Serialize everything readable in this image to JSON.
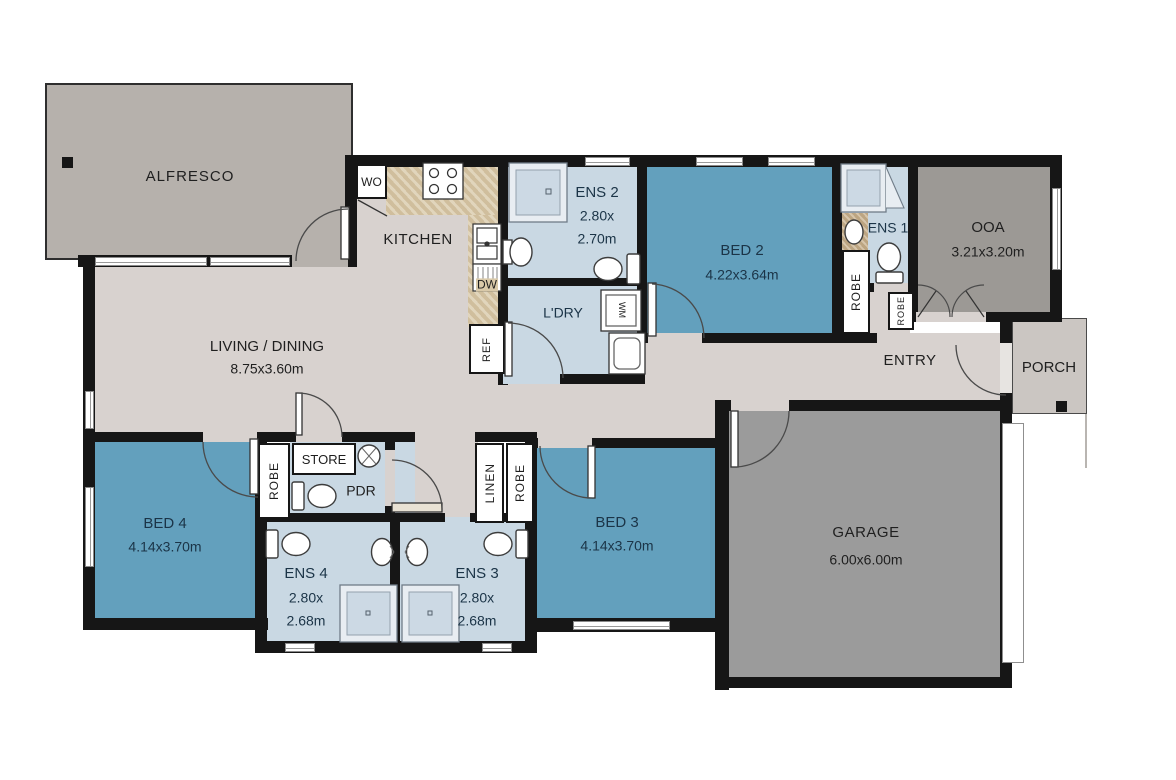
{
  "colors": {
    "wall": "#161616",
    "floor_main": "#d8d2cf",
    "floor_bedroom": "#63a0bd",
    "floor_wet_area": "#c9d8e3",
    "floor_alfresco": "#b6b1ac",
    "floor_garage": "#9b9b9b",
    "floor_ooa": "#9c9995",
    "floor_porch": "#cbc6c2",
    "benchtop": "#d9c9a9",
    "vanity": "#c8b18e",
    "label_text": "#1f1f1f",
    "label_text_blue_rooms": "#1b3447"
  },
  "rooms": {
    "alfresco": {
      "name": "ALFRESCO"
    },
    "kitchen": {
      "name": "KITCHEN"
    },
    "living": {
      "name": "LIVING / DINING",
      "dims": "8.75x3.60m"
    },
    "ens2": {
      "name": "ENS 2",
      "dims_a": "2.80x",
      "dims_b": "2.70m"
    },
    "laundry": {
      "name": "L'DRY"
    },
    "bed2": {
      "name": "BED 2",
      "dims": "4.22x3.64m"
    },
    "ens1": {
      "name": "ENS 1"
    },
    "ooa": {
      "name": "OOA",
      "dims": "3.21x3.20m"
    },
    "entry": {
      "name": "ENTRY"
    },
    "porch": {
      "name": "PORCH"
    },
    "garage": {
      "name": "GARAGE",
      "dims": "6.00x6.00m"
    },
    "bed4": {
      "name": "BED 4",
      "dims": "4.14x3.70m"
    },
    "bed3": {
      "name": "BED 3",
      "dims": "4.14x3.70m"
    },
    "ens4": {
      "name": "ENS 4",
      "dims_a": "2.80x",
      "dims_b": "2.68m"
    },
    "ens3": {
      "name": "ENS 3",
      "dims_a": "2.80x",
      "dims_b": "2.68m"
    },
    "pdr": {
      "name": "PDR"
    },
    "store": {
      "name": "STORE"
    }
  },
  "closets": {
    "robe_bed2": "ROBE",
    "robe_entry": "ROBE",
    "robe_bed4": "ROBE",
    "linen": "LINEN",
    "robe_hall": "ROBE"
  },
  "appliances": {
    "wall_oven": "WO",
    "dishwasher": "DW",
    "fridge": "REF",
    "washing_machine": "WM"
  }
}
